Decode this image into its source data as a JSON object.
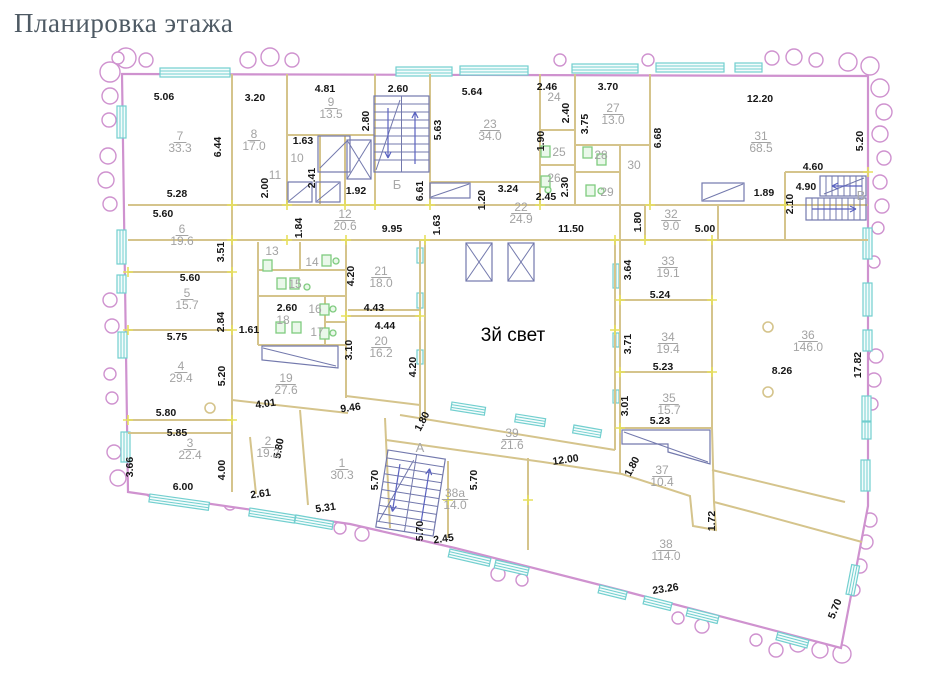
{
  "title": "Планировка этажа",
  "colors": {
    "outer_wall": "#cf92cf",
    "window": "#72cfcf",
    "inner_wall": "#d5c48c",
    "stair_detail": "#7379ad",
    "fixture": "#7fcb7f",
    "dimension_text": "#161616",
    "room_text": "#a3a3a3",
    "tick": "#e7e05e",
    "title_text": "#4e5a64"
  },
  "plan": {
    "text_labels": [
      {
        "t": "3й свет",
        "x": 513,
        "y": 341,
        "cls": "atrium"
      },
      {
        "t": "Б",
        "x": 397,
        "y": 189,
        "cls": "stair"
      },
      {
        "t": "А",
        "x": 420,
        "y": 452,
        "cls": "stair"
      },
      {
        "t": "В",
        "x": 861,
        "y": 200,
        "cls": "stair"
      }
    ],
    "rooms": [
      {
        "n": "1",
        "a": "30.3",
        "x": 342,
        "y": 467
      },
      {
        "n": "2",
        "a": "19.2",
        "x": 268,
        "y": 445
      },
      {
        "n": "3",
        "a": "22.4",
        "x": 190,
        "y": 447
      },
      {
        "n": "4",
        "a": "29.4",
        "x": 181,
        "y": 370
      },
      {
        "n": "5",
        "a": "15.7",
        "x": 187,
        "y": 297
      },
      {
        "n": "6",
        "a": "19.6",
        "x": 182,
        "y": 233
      },
      {
        "n": "7",
        "a": "33.3",
        "x": 180,
        "y": 140
      },
      {
        "n": "8",
        "a": "17.0",
        "x": 254,
        "y": 138
      },
      {
        "n": "9",
        "a": "13.5",
        "x": 331,
        "y": 106
      },
      {
        "n": "10",
        "a": "",
        "x": 297,
        "y": 162
      },
      {
        "n": "11",
        "a": "",
        "x": 275,
        "y": 179
      },
      {
        "n": "12",
        "a": "20.6",
        "x": 345,
        "y": 218
      },
      {
        "n": "13",
        "a": "",
        "x": 272,
        "y": 255
      },
      {
        "n": "14",
        "a": "",
        "x": 312,
        "y": 266
      },
      {
        "n": "15",
        "a": "",
        "x": 295,
        "y": 288
      },
      {
        "n": "16",
        "a": "",
        "x": 315,
        "y": 313
      },
      {
        "n": "17",
        "a": "",
        "x": 317,
        "y": 336
      },
      {
        "n": "18",
        "a": "",
        "x": 283,
        "y": 324
      },
      {
        "n": "19",
        "a": "27.6",
        "x": 286,
        "y": 382
      },
      {
        "n": "20",
        "a": "16.2",
        "x": 381,
        "y": 345
      },
      {
        "n": "21",
        "a": "18.0",
        "x": 381,
        "y": 275
      },
      {
        "n": "22",
        "a": "24.9",
        "x": 521,
        "y": 211
      },
      {
        "n": "23",
        "a": "34.0",
        "x": 490,
        "y": 128
      },
      {
        "n": "24",
        "a": "",
        "x": 554,
        "y": 101
      },
      {
        "n": "25",
        "a": "",
        "x": 559,
        "y": 156
      },
      {
        "n": "26",
        "a": "",
        "x": 554,
        "y": 182
      },
      {
        "n": "27",
        "a": "13.0",
        "x": 613,
        "y": 112
      },
      {
        "n": "28",
        "a": "",
        "x": 601,
        "y": 159
      },
      {
        "n": "29",
        "a": "",
        "x": 607,
        "y": 196
      },
      {
        "n": "30",
        "a": "",
        "x": 634,
        "y": 169
      },
      {
        "n": "31",
        "a": "68.5",
        "x": 761,
        "y": 140
      },
      {
        "n": "32",
        "a": "9.0",
        "x": 671,
        "y": 218
      },
      {
        "n": "33",
        "a": "19.1",
        "x": 668,
        "y": 265
      },
      {
        "n": "34",
        "a": "19.4",
        "x": 668,
        "y": 341
      },
      {
        "n": "35",
        "a": "15.7",
        "x": 669,
        "y": 402
      },
      {
        "n": "36",
        "a": "146.0",
        "x": 808,
        "y": 339
      },
      {
        "n": "37",
        "a": "10.4",
        "x": 662,
        "y": 474
      },
      {
        "n": "38",
        "a": "114.0",
        "x": 666,
        "y": 548
      },
      {
        "n": "38а",
        "a": "14.0",
        "x": 455,
        "y": 497
      },
      {
        "n": "39",
        "a": "21.6",
        "x": 512,
        "y": 437
      }
    ],
    "dims": [
      {
        "t": "5.06",
        "x": 164,
        "y": 100
      },
      {
        "t": "3.20",
        "x": 255,
        "y": 101
      },
      {
        "t": "4.81",
        "x": 325,
        "y": 92
      },
      {
        "t": "2.60",
        "x": 398,
        "y": 92
      },
      {
        "t": "5.64",
        "x": 472,
        "y": 95
      },
      {
        "t": "2.46",
        "x": 547,
        "y": 90
      },
      {
        "t": "3.70",
        "x": 608,
        "y": 90
      },
      {
        "t": "12.20",
        "x": 760,
        "y": 102
      },
      {
        "t": "6.44",
        "x": 221,
        "y": 147,
        "r": -90
      },
      {
        "t": "2.80",
        "x": 369,
        "y": 121,
        "r": -90
      },
      {
        "t": "1.63",
        "x": 303,
        "y": 144
      },
      {
        "t": "2.41",
        "x": 315,
        "y": 178,
        "r": -90
      },
      {
        "t": "5.63",
        "x": 441,
        "y": 130,
        "r": -90
      },
      {
        "t": "2.40",
        "x": 569,
        "y": 113,
        "r": -90
      },
      {
        "t": "3.75",
        "x": 588,
        "y": 124,
        "r": -90
      },
      {
        "t": "1.90",
        "x": 544,
        "y": 141,
        "r": -90
      },
      {
        "t": "6.68",
        "x": 661,
        "y": 138,
        "r": -90
      },
      {
        "t": "5.20",
        "x": 863,
        "y": 141,
        "r": -90
      },
      {
        "t": "2.00",
        "x": 268,
        "y": 188,
        "r": -90
      },
      {
        "t": "5.28",
        "x": 177,
        "y": 197
      },
      {
        "t": "1.92",
        "x": 356,
        "y": 194
      },
      {
        "t": "6.61",
        "x": 423,
        "y": 191,
        "r": -90
      },
      {
        "t": "1.20",
        "x": 485,
        "y": 200,
        "r": -90
      },
      {
        "t": "3.24",
        "x": 508,
        "y": 192
      },
      {
        "t": "2.45",
        "x": 546,
        "y": 200
      },
      {
        "t": "2.30",
        "x": 568,
        "y": 187,
        "r": -90
      },
      {
        "t": "1.89",
        "x": 764,
        "y": 196
      },
      {
        "t": "4.60",
        "x": 813,
        "y": 170
      },
      {
        "t": "4.90",
        "x": 806,
        "y": 190
      },
      {
        "t": "2.10",
        "x": 793,
        "y": 204,
        "r": -90
      },
      {
        "t": "5.60",
        "x": 163,
        "y": 217
      },
      {
        "t": "1.84",
        "x": 302,
        "y": 228,
        "r": -90
      },
      {
        "t": "9.95",
        "x": 392,
        "y": 232
      },
      {
        "t": "1.63",
        "x": 440,
        "y": 225,
        "r": -90
      },
      {
        "t": "11.50",
        "x": 571,
        "y": 232
      },
      {
        "t": "1.80",
        "x": 641,
        "y": 222,
        "r": -90
      },
      {
        "t": "5.00",
        "x": 705,
        "y": 232
      },
      {
        "t": "3.51",
        "x": 224,
        "y": 252,
        "r": -90
      },
      {
        "t": "5.60",
        "x": 190,
        "y": 281
      },
      {
        "t": "2.84",
        "x": 224,
        "y": 322,
        "r": -90
      },
      {
        "t": "5.75",
        "x": 177,
        "y": 340
      },
      {
        "t": "5.20",
        "x": 225,
        "y": 376,
        "r": -90
      },
      {
        "t": "5.80",
        "x": 166,
        "y": 416
      },
      {
        "t": "5.85",
        "x": 177,
        "y": 436
      },
      {
        "t": "3.66",
        "x": 133,
        "y": 467,
        "r": -90
      },
      {
        "t": "4.00",
        "x": 225,
        "y": 470,
        "r": -90
      },
      {
        "t": "6.00",
        "x": 183,
        "y": 490
      },
      {
        "t": "2.61",
        "x": 261,
        "y": 497,
        "r": -8
      },
      {
        "t": "4.20",
        "x": 354,
        "y": 276,
        "r": -90
      },
      {
        "t": "2.60",
        "x": 287,
        "y": 311
      },
      {
        "t": "1.61",
        "x": 249,
        "y": 333
      },
      {
        "t": "4.43",
        "x": 374,
        "y": 311
      },
      {
        "t": "4.44",
        "x": 385,
        "y": 329
      },
      {
        "t": "3.10",
        "x": 352,
        "y": 350,
        "r": -90
      },
      {
        "t": "4.20",
        "x": 416,
        "y": 367,
        "r": -90
      },
      {
        "t": "4.01",
        "x": 266,
        "y": 407,
        "r": -8
      },
      {
        "t": "9.46",
        "x": 351,
        "y": 411,
        "r": -8
      },
      {
        "t": "5.80",
        "x": 282,
        "y": 449,
        "r": -80
      },
      {
        "t": "5.31",
        "x": 326,
        "y": 511,
        "r": -8
      },
      {
        "t": "5.70",
        "x": 378,
        "y": 480,
        "r": -90
      },
      {
        "t": "1.80",
        "x": 425,
        "y": 423,
        "r": -62
      },
      {
        "t": "12.00",
        "x": 566,
        "y": 463,
        "r": -8
      },
      {
        "t": "5.70",
        "x": 477,
        "y": 480,
        "r": -90
      },
      {
        "t": "5.70",
        "x": 423,
        "y": 531,
        "r": -90
      },
      {
        "t": "2.45",
        "x": 444,
        "y": 542,
        "r": -8
      },
      {
        "t": "3.64",
        "x": 631,
        "y": 270,
        "r": -90
      },
      {
        "t": "5.24",
        "x": 660,
        "y": 298
      },
      {
        "t": "3.71",
        "x": 631,
        "y": 344,
        "r": -90
      },
      {
        "t": "5.23",
        "x": 663,
        "y": 370
      },
      {
        "t": "3.01",
        "x": 628,
        "y": 406,
        "r": -90
      },
      {
        "t": "5.23",
        "x": 660,
        "y": 424
      },
      {
        "t": "8.26",
        "x": 782,
        "y": 374
      },
      {
        "t": "17.82",
        "x": 861,
        "y": 365,
        "r": -90
      },
      {
        "t": "1.80",
        "x": 635,
        "y": 468,
        "r": -62
      },
      {
        "t": "1.72",
        "x": 715,
        "y": 521,
        "r": -90
      },
      {
        "t": "23.26",
        "x": 666,
        "y": 592,
        "r": -9
      },
      {
        "t": "5.70",
        "x": 838,
        "y": 610,
        "r": -68
      }
    ]
  }
}
